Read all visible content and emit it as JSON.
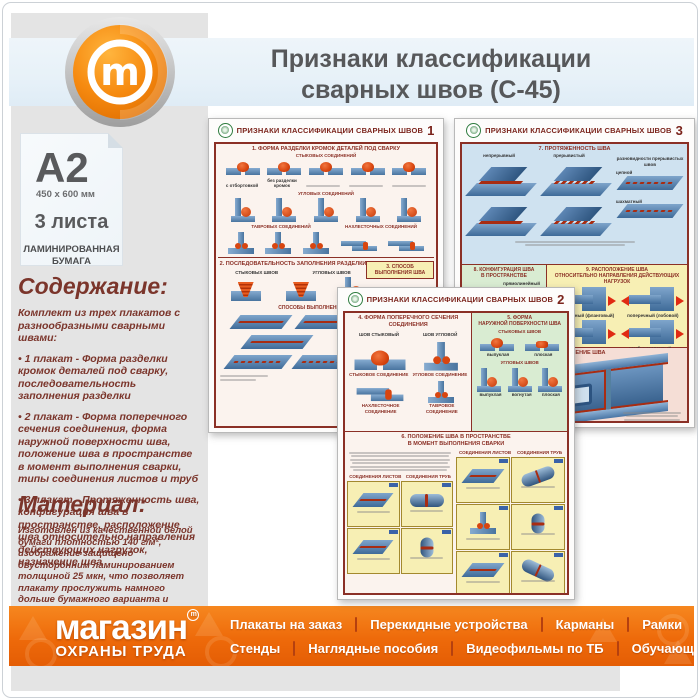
{
  "header": {
    "title_line1": "Признаки классификации",
    "title_line2": "сварных швов (С-45)",
    "logo_letter": "m"
  },
  "sidebar": {
    "format_card": {
      "format": "A2",
      "dimensions": "450 x 600 мм",
      "sheets": "3 листа",
      "paper_line1": "ЛАМИНИРОВАННАЯ",
      "paper_line2": "БУМАГА"
    },
    "content": {
      "heading": "Содержание:",
      "intro": "Комплект из трех плакатов с разнообразными сварными швами:",
      "item1": "• 1 плакат - Форма разделки кромок деталей под сварку, последовательность заполнения разделки",
      "item2": "• 2 плакат - Форма поперечного сечения соединения, форма наружной поверхности шва, положение шва в пространстве в момент выполнения сварки, типы соединения листов и труб",
      "item3": "• 3 плакат - Протяженность шва, конфигурация шва в пространстве, расположение шва относительно направления действующих нагрузок, назначение шва"
    },
    "material": {
      "heading": "Материал:",
      "text": "Изготовлен из качественной белой бумаги плотностью 140 г/м², изображение защищено двусторонним ламинированием толщиной 25 мкн, что позволяет плакату прослужить намного дольше бумажного варианта и такой плакат не боится влаги - его смело можно протирать."
    }
  },
  "posters": {
    "p1": {
      "title": "ПРИЗНАКИ КЛАССИФИКАЦИИ СВАРНЫХ ШВОВ",
      "number": "1",
      "s1_title": "1. ФОРМА РАЗДЕЛКИ КРОМОК ДЕТАЛЕЙ ПОД СВАРКУ",
      "butt_label": "СТЫКОВЫХ СОЕДИНЕНИЙ",
      "edge1": "с отбортовкой",
      "edge2": "без разделки кромок",
      "corner_label": "УГЛОВЫХ СОЕДИНЕНИЙ",
      "tee_label": "ТАВРОВЫХ СОЕДИНЕНИЙ",
      "lap_label": "НАХЛЕСТОЧНЫХ СОЕДИНЕНИЙ",
      "s2_title": "2. ПОСЛЕДОВАТЕЛЬНОСТЬ ЗАПОЛНЕНИЯ РАЗДЕЛКИ",
      "s2_butt": "СТЫКОВЫХ ШВОВ",
      "s2_corner": "УГЛОВЫХ ШВОВ",
      "s3_title": "3. СПОСОБ ВЫПОЛНЕНИЯ ШВА",
      "passes_title": "СПОСОБЫ ВЫПОЛНЕНИЯ ПРОХОДОВ"
    },
    "p2": {
      "title": "ПРИЗНАКИ КЛАССИФИКАЦИИ СВАРНЫХ ШВОВ",
      "number": "2",
      "s4_title": "4. ФОРМА ПОПЕРЕЧНОГО СЕЧЕНИЯ СОЕДИНЕНИЯ",
      "butt_seam": "ШОВ СТЫКОВЫЙ",
      "fillet_seam": "ШОВ УГЛОВОЙ",
      "butt_joint": "СТЫКОВОЕ СОЕДИНЕНИЕ",
      "corner_joint": "УГЛОВОЕ СОЕДИНЕНИЕ",
      "lap_joint": "НАХЛЕСТОЧНОЕ СОЕДИНЕНИЕ",
      "tee_joint": "ТАВРОВОЕ СОЕДИНЕНИЕ",
      "s5_title1": "5. ФОРМА",
      "s5_title2": "НАРУЖНОЙ ПОВЕРХНОСТИ ШВА",
      "s5_butt": "СТЫКОВЫХ ШВОВ",
      "s5_fillet": "УГЛОВЫХ ШВОВ",
      "convex": "выпуклая",
      "flat": "плоская",
      "concave": "вогнутая",
      "s6_title1": "6. ПОЛОЖЕНИЕ ШВА В ПРОСТРАНСТВЕ",
      "s6_title2": "В МОМЕНТ ВЫПОЛНЕНИЯ СВАРКИ",
      "sheets": "СОЕДИНЕНИЯ ЛИСТОВ",
      "pipes": "СОЕДИНЕНИЯ ТРУБ"
    },
    "p3": {
      "title": "ПРИЗНАКИ КЛАССИФИКАЦИИ СВАРНЫХ ШВОВ",
      "number": "3",
      "s7_title": "7. ПРОТЯЖЕННОСТЬ ШВА",
      "continuous": "непрерывный",
      "intermittent": "прерывистый",
      "varieties": "разновидности прерывистых швов",
      "chain": "цепной",
      "staggered": "шахматный",
      "s8_title1": "8. КОНФИГУРАЦИЯ ШВА",
      "s8_title2": "В ПРОСТРАНСТВЕ",
      "straight": "прямолинейный",
      "ring": "кольцевой",
      "s9_title1": "9. РАСПОЛОЖЕНИЕ ШВА",
      "s9_title2": "ОТНОСИТЕЛЬНО НАПРАВЛЕНИЯ ДЕЙСТВУЮЩИХ НАГРУЗОК",
      "longitudinal": "продольный (фланговый)",
      "transverse": "поперечный (лобовой)",
      "combined": "комбинированный",
      "s10_title": "10. НАЗНАЧЕНИЕ ШВА"
    }
  },
  "footer": {
    "brand_line1": "магазин",
    "brand_line2": "ОХРАНЫ ТРУДА",
    "trademark": "m",
    "menu_row1": [
      "Плакаты на заказ",
      "Перекидные устройства",
      "Карманы",
      "Рамки",
      "Багет"
    ],
    "menu_row2": [
      "Стенды",
      "Наглядные пособия",
      "Видеофильмы по ТБ",
      "Обучающие программы"
    ]
  },
  "colors": {
    "brand_orange": "#f58220",
    "footer_orange": "#ee6a0a",
    "heading_maroon": "#7b352b",
    "poster_frame_red": "#8b3026",
    "plate_blue": "#5b87b8",
    "weld_orange": "#d8450f",
    "header_band_blue": "#e7f1f8",
    "sidebar_gray": "#e4e4e4",
    "section_green": "#d9ecd2",
    "section_yellow": "#f7efb4",
    "section_pink": "#f5ded6"
  }
}
